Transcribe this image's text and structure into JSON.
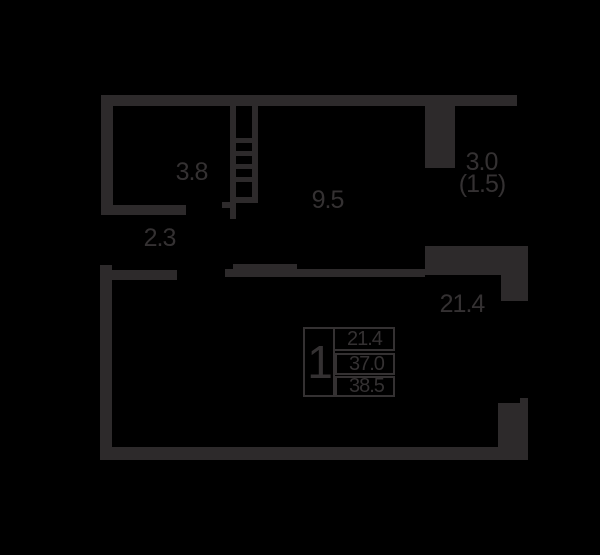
{
  "title": "apartment-floor-plan",
  "colors": {
    "background": "#000000",
    "wall": "#2d2a2b",
    "text": "#343132"
  },
  "icons": {
    "staircase": "staircase-icon"
  },
  "rooms": {
    "storage": {
      "label": "3.8"
    },
    "hallway": {
      "label": "9.5"
    },
    "corridor": {
      "label": "2.3"
    },
    "balcony": {
      "label": "3.0",
      "label_reduced": "(1.5)"
    },
    "living": {
      "label": "21.4"
    }
  },
  "legend": {
    "rooms_count": "1",
    "rows": [
      "21.4",
      "37.0",
      "38.5"
    ]
  }
}
